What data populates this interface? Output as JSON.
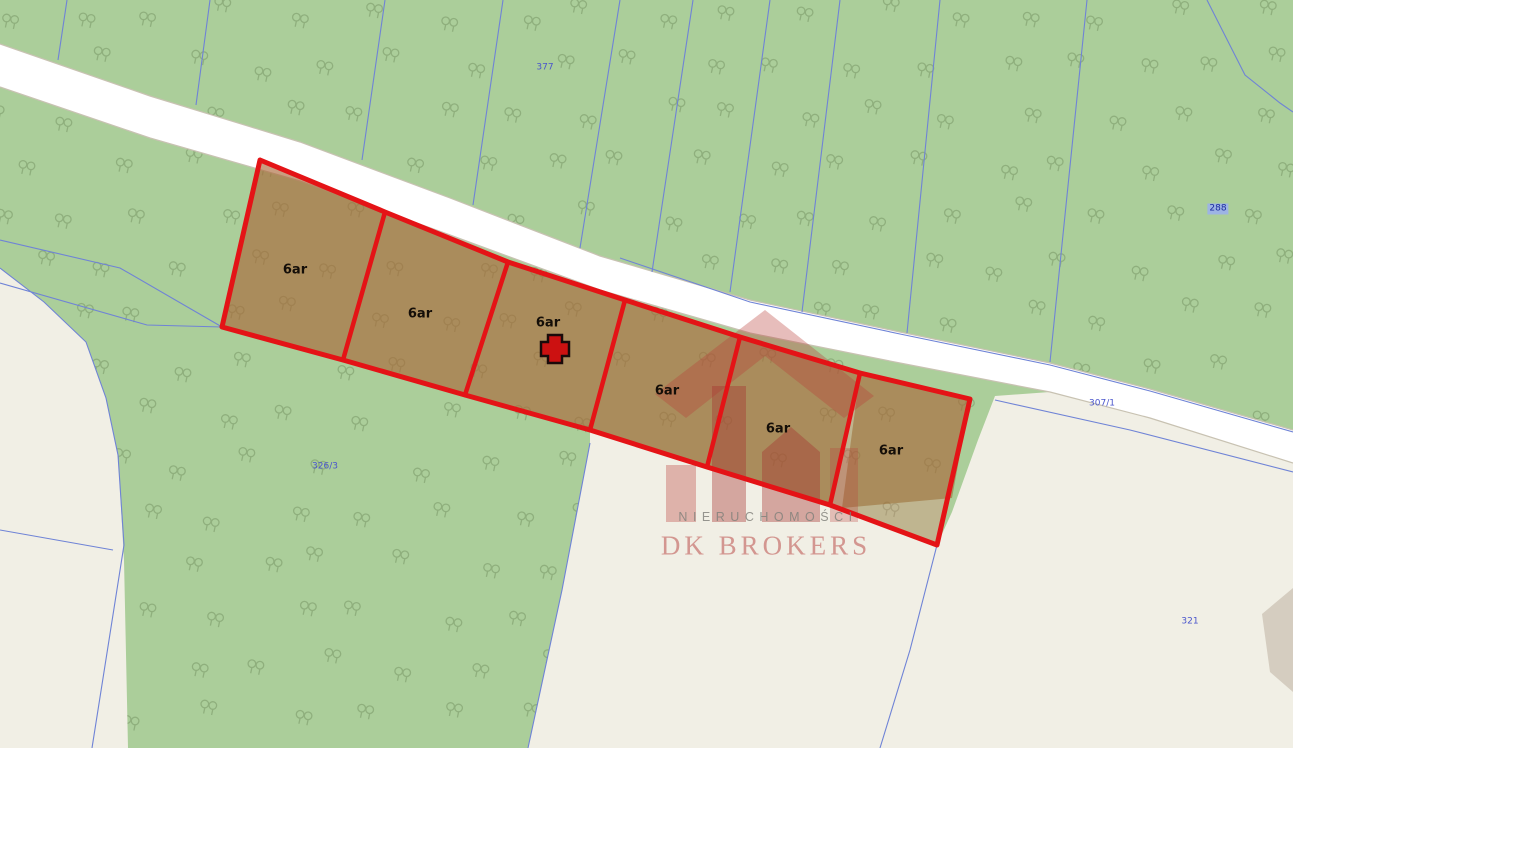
{
  "map": {
    "parcel_labels": [
      {
        "text": "377",
        "x": 545,
        "y": 68,
        "highlighted": false
      },
      {
        "text": "288",
        "x": 1218,
        "y": 209,
        "highlighted": true
      },
      {
        "text": "326/3",
        "x": 325,
        "y": 467,
        "highlighted": false
      },
      {
        "text": "307/1",
        "x": 1102,
        "y": 404,
        "highlighted": false
      },
      {
        "text": "321",
        "x": 1190,
        "y": 622,
        "highlighted": false
      }
    ],
    "plots": [
      {
        "label": "6ar",
        "x": 295,
        "y": 270
      },
      {
        "label": "6ar",
        "x": 420,
        "y": 314
      },
      {
        "label": "6ar",
        "x": 548,
        "y": 323
      },
      {
        "label": "6ar",
        "x": 667,
        "y": 391
      },
      {
        "label": "6ar",
        "x": 778,
        "y": 429
      },
      {
        "label": "6ar",
        "x": 891,
        "y": 451
      }
    ],
    "marker": {
      "type": "cross",
      "x": 555,
      "y": 349
    },
    "watermark": {
      "line1": "NIERUCHOMOŚCI",
      "line2": "DK BROKERS",
      "cx1": 768,
      "cy1": 517,
      "cx2": 766,
      "cy2": 546
    },
    "colors": {
      "forest_green": "#abce9a",
      "field_beige": "#f1efe5",
      "road_white": "#ffffff",
      "road_edge_gray": "#c8c2b2",
      "boundary_blue": "#6f83d6",
      "plot_outline_red": "#e41316",
      "plot_fill_tan": "rgba(150,100,40,0.5)",
      "plot_fill_pink": "rgba(244,120,120,0.28)",
      "tree_symbol_green": "#7d9c6b",
      "watermark_red": "rgba(185,62,56,0.34)",
      "gray_building": "#d5cdc0",
      "label_blue": "#4a55cc"
    }
  }
}
